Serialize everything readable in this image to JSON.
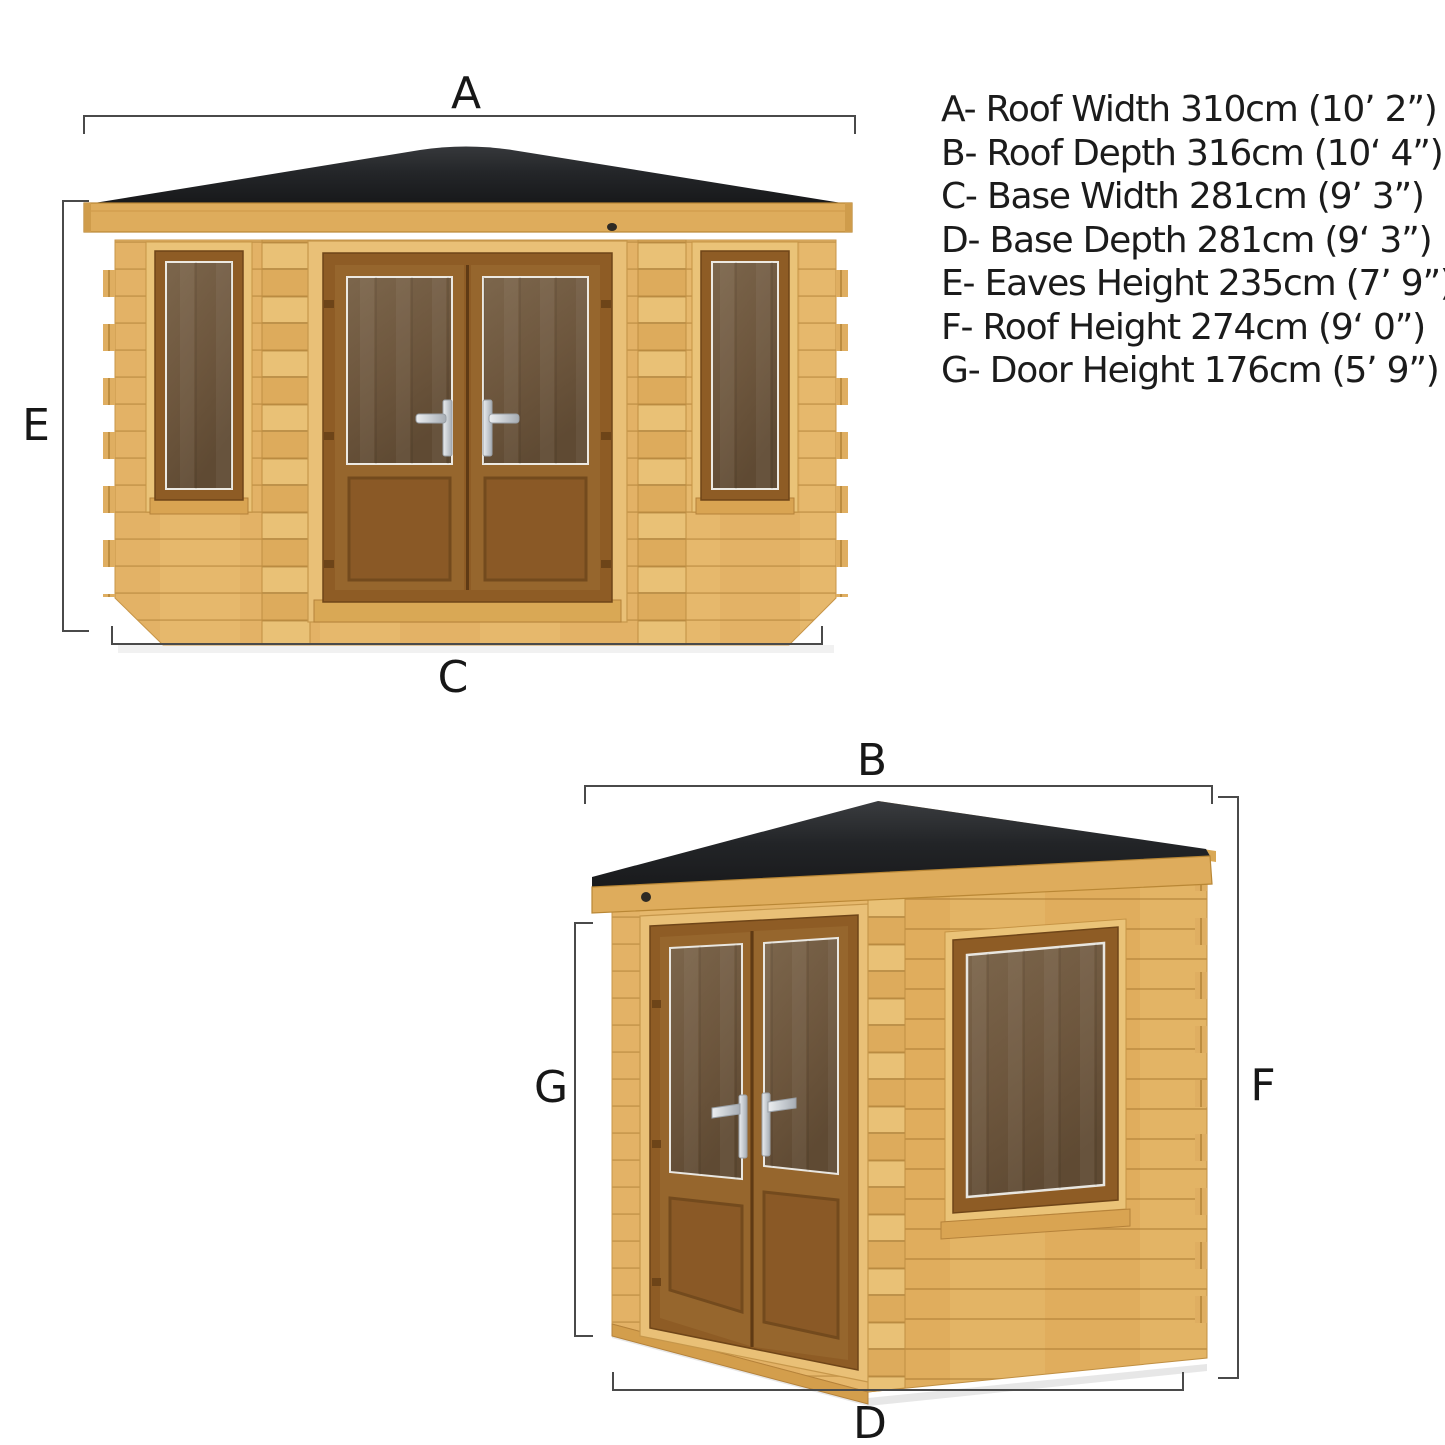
{
  "figure": {
    "type": "product-dimension-diagram",
    "product": "corner log cabin summerhouse",
    "views": [
      {
        "id": "front-view",
        "dimension_markers": [
          "A",
          "E",
          "C"
        ]
      },
      {
        "id": "side-view",
        "dimension_markers": [
          "B",
          "G",
          "F",
          "D"
        ]
      }
    ]
  },
  "dims": [
    {
      "letter": "A",
      "name": "Roof Width",
      "metric": "310cm",
      "imperial": "10’ 2”",
      "display": "A- Roof Width 310cm (10’ 2”)"
    },
    {
      "letter": "B",
      "name": "Roof Depth",
      "metric": "316cm",
      "imperial": "10‘ 4”",
      "display": "B- Roof Depth 316cm (10‘ 4”)"
    },
    {
      "letter": "C",
      "name": "Base Width",
      "metric": "281cm",
      "imperial": "9’ 3”",
      "display": "C- Base Width 281cm (9’ 3”)"
    },
    {
      "letter": "D",
      "name": "Base Depth",
      "metric": "281cm",
      "imperial": "9‘ 3”",
      "display": "D- Base Depth 281cm (9‘ 3”)"
    },
    {
      "letter": "E",
      "name": "Eaves Height",
      "metric": "235cm",
      "imperial": "7’ 9”",
      "display": "E- Eaves Height 235cm (7’ 9”)"
    },
    {
      "letter": "F",
      "name": "Roof Height",
      "metric": "274cm",
      "imperial": "9‘ 0”",
      "display": "F- Roof Height 274cm (9‘ 0”)"
    },
    {
      "letter": "G",
      "name": "Door Height",
      "metric": "176cm",
      "imperial": "5’ 9”",
      "display": "G- Door Height 176cm (5’ 9”)"
    }
  ],
  "colors": {
    "background": "#ffffff",
    "wall_wood": "#e3b266",
    "wood_shadow": "#b5873c",
    "fascia_wood": "#deac5c",
    "roof_felt": "#202124",
    "joinery_brown": "#8e5c25",
    "glass_tint": "#6f5941",
    "handle_silver": "#d9dcdf",
    "dimension_line": "#4a4a4a",
    "text": "#1b1b1b"
  }
}
